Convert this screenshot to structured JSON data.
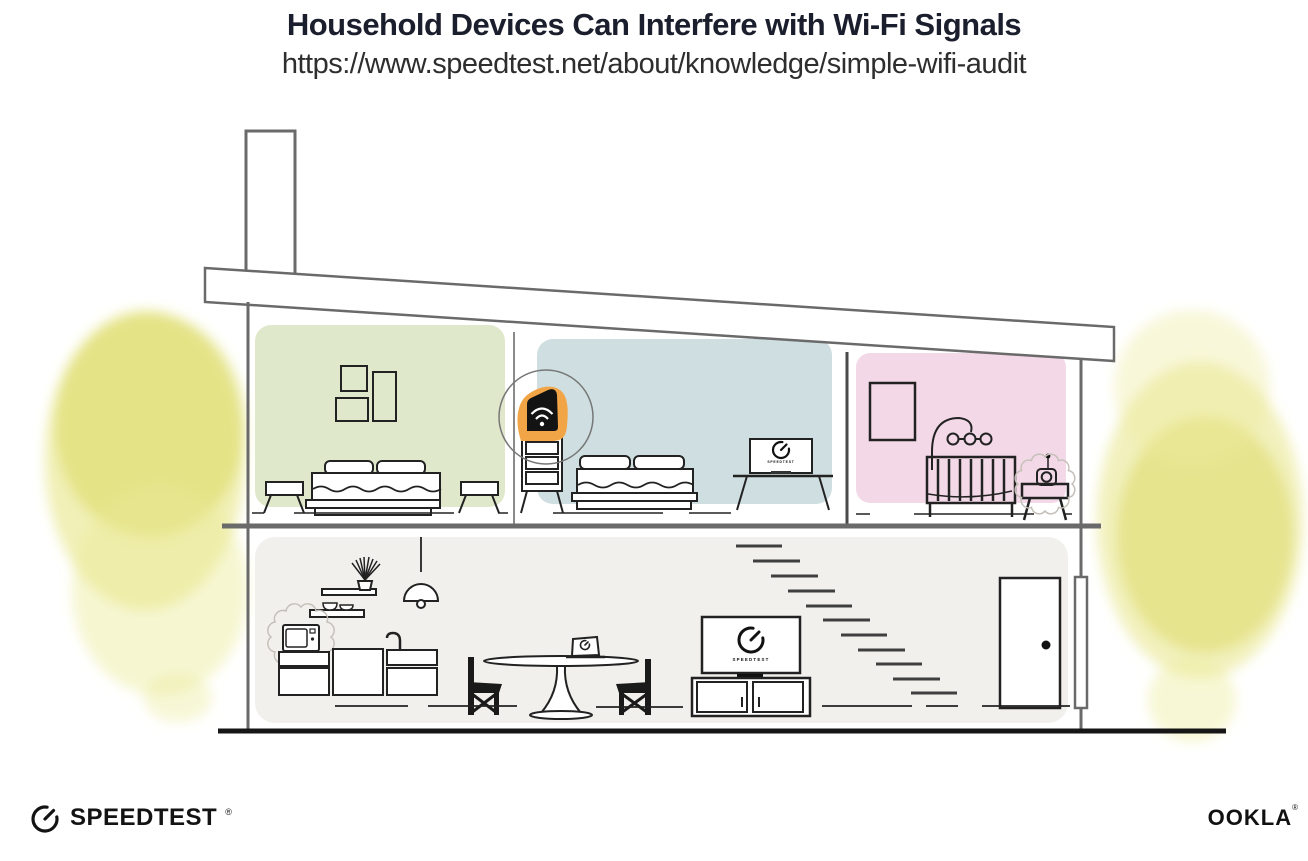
{
  "header": {
    "title": "Household Devices Can Interfere with Wi-Fi Signals",
    "url": "https://www.speedtest.net/about/knowledge/simple-wifi-audit"
  },
  "illustration": {
    "screen_label": "SPEEDTEST",
    "router": {
      "icon": "wifi-router-icon",
      "highlight_color": "#f2a546"
    },
    "interference_devices": [
      "microwave-icon",
      "baby-monitor-icon"
    ],
    "rooms": [
      {
        "name": "bedroom-left",
        "color": "#e0e8cb"
      },
      {
        "name": "bedroom-middle",
        "color": "#cfdee0"
      },
      {
        "name": "nursery",
        "color": "#f3d9e7"
      },
      {
        "name": "ground-floor",
        "color": "#f1f0ed"
      }
    ],
    "colors": {
      "line_gray": "#6a6a6a",
      "ink_black": "#1a1a1a",
      "watercolor_yellow": "#e6e47c",
      "router_orange": "#f2a546"
    }
  },
  "footer": {
    "speedtest": {
      "label": "SPEEDTEST",
      "mark": "®",
      "icon": "speedtest-gauge-icon"
    },
    "ookla": {
      "label": "OOKLA",
      "mark": "®"
    }
  }
}
